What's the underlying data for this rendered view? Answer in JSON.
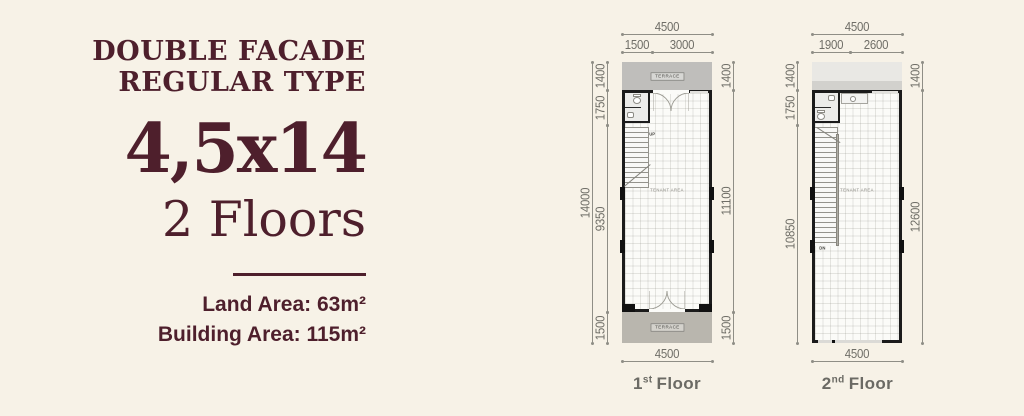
{
  "colors": {
    "background": "#f7f2e7",
    "accent_maroon": "#4e1f2c",
    "dim_gray": "#6f6e67",
    "wall_black": "#1b1b1b",
    "terrace_gray": "#bfbebb",
    "roof_gray": "#e9e8e4"
  },
  "info": {
    "title_line1": "DOUBLE FACADE",
    "title_line2": "REGULAR TYPE",
    "size": "4,5x14",
    "floors": "2 Floors",
    "land_area": "Land Area: 63m²",
    "building_area": "Building Area: 115m²"
  },
  "plans": {
    "first": {
      "label_num": "1",
      "label_suffix": "st",
      "label_word": "Floor",
      "dim_top_total": "4500",
      "dim_top_seg1": "1500",
      "dim_top_seg2": "3000",
      "dim_left_total": "14000",
      "dim_left_seg1": "1400",
      "dim_left_seg2": "1750",
      "dim_left_seg3": "9350",
      "dim_left_seg4": "1500",
      "dim_right_seg1": "1400",
      "dim_right_seg2": "11100",
      "dim_right_seg3": "1500",
      "dim_bottom": "4500",
      "terrace_top": "TERRACE",
      "terrace_bottom": "TERRACE",
      "tenant_area": "TENANT AREA",
      "stair_label": "UP"
    },
    "second": {
      "label_num": "2",
      "label_suffix": "nd",
      "label_word": "Floor",
      "dim_top_total": "4500",
      "dim_top_seg1": "1900",
      "dim_top_seg2": "2600",
      "dim_left_seg1": "1400",
      "dim_left_seg2": "1750",
      "dim_left_seg3": "10850",
      "dim_right_seg1": "1400",
      "dim_right_seg2": "12600",
      "dim_bottom": "4500",
      "tenant_area": "TENANT AREA",
      "stair_label": "DN"
    }
  }
}
